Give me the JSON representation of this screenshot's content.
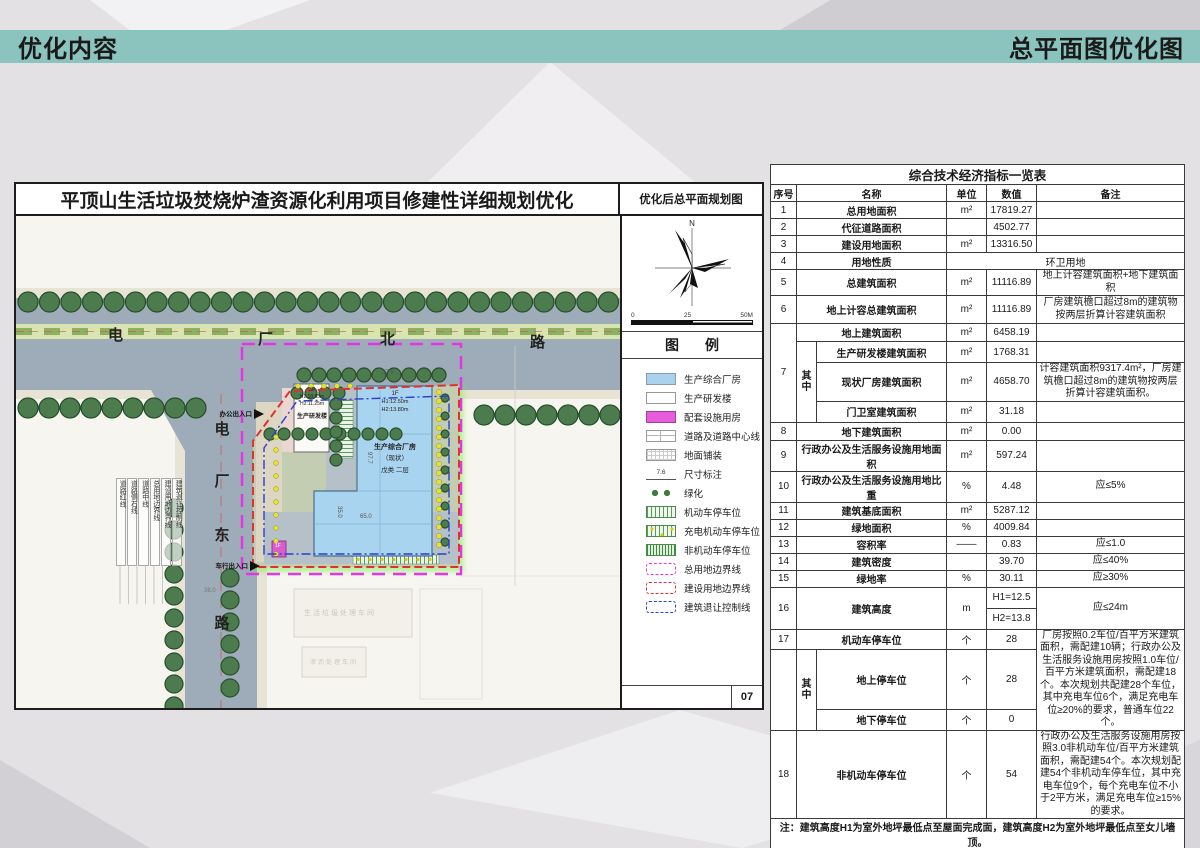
{
  "header": {
    "left_title": "优化内容",
    "right_title": "总平面图优化图"
  },
  "colors": {
    "accent_teal": "#8bc3bf",
    "boundary_magenta": "#e336e3",
    "boundary_red": "#e03030",
    "setback_blue": "#2b3fd0",
    "building_blue": "#a9d4f0",
    "road_gray": "#9dacb8"
  },
  "plan": {
    "title": "平顶山生活垃圾焚烧炉渣资源化利用项目修建性详细规划优化",
    "subtitle": "优化后总平面规划图",
    "page_number": "07",
    "compass_north": "N",
    "scale": {
      "start": "0",
      "mid": "25",
      "end": "50M"
    },
    "legend_title": "图例",
    "legend_items": [
      {
        "label": "生产综合厂房",
        "type": "fill-blue"
      },
      {
        "label": "生产研发楼",
        "type": "fill-white"
      },
      {
        "label": "配套设施用房",
        "type": "fill-magenta"
      },
      {
        "label": "道路及道路中心线",
        "type": "road"
      },
      {
        "label": "地面铺装",
        "type": "paving"
      },
      {
        "label": "尺寸标注",
        "type": "dimension",
        "sample": "7.6"
      },
      {
        "label": "绿化",
        "type": "trees"
      },
      {
        "label": "机动车停车位",
        "type": "parking"
      },
      {
        "label": "充电机动车停车位",
        "type": "parking-ev"
      },
      {
        "label": "非机动车停车位",
        "type": "parking-bike"
      },
      {
        "label": "总用地边界线",
        "type": "dash-magenta"
      },
      {
        "label": "建设用地边界线",
        "type": "dash-red"
      },
      {
        "label": "建筑退让控制线",
        "type": "dash-blue"
      }
    ],
    "map": {
      "road_h_name": [
        "电",
        "厂",
        "北",
        "路"
      ],
      "road_v_name": [
        "电",
        "厂",
        "东",
        "路"
      ],
      "buildings": {
        "rnd": {
          "floors": "3F",
          "h1": "H1:10.65m",
          "h2": "H2:11.25m",
          "name": "生产研发楼"
        },
        "factory": {
          "floors": "1F",
          "h1": "H1:12.50m",
          "h2": "H2:13.80m",
          "name": "生产综合厂房",
          "name2": "（现状）",
          "name3": "戊类 二层"
        },
        "gatehouse": {
          "floors": "1F"
        }
      },
      "labels": {
        "office_entrance": "办公出入口",
        "vehicle_entrance": "车行出入口",
        "adjacent1": "生活垃圾处理车间",
        "adjacent2": "渗沥处理车间"
      },
      "dims": {
        "top": "37.6",
        "side": "97.7",
        "inner": "65.0",
        "inner2": "35.0",
        "road": "38.0"
      },
      "line_labels": [
        "道路红线",
        "道路侧石线",
        "道路中线",
        "总用地边界线",
        "建设用地边界线",
        "建筑退让控制线"
      ]
    }
  },
  "table": {
    "rows": [
      {
        "cls": "h20 title-row",
        "cells": [
          {
            "t": "综合技术经济指标一览表",
            "c": 6,
            "cls": "tt"
          }
        ]
      },
      {
        "cls": "h17 head-row",
        "cells": [
          {
            "t": "序号"
          },
          {
            "t": "名称",
            "c": 2
          },
          {
            "t": "单位"
          },
          {
            "t": "数值"
          },
          {
            "t": "备注"
          }
        ]
      },
      {
        "cls": "h17",
        "cells": [
          {
            "t": "1"
          },
          {
            "t": "总用地面积",
            "c": 2,
            "cls": "name"
          },
          {
            "t": "m²"
          },
          {
            "t": "17819.27"
          },
          {
            "t": ""
          }
        ]
      },
      {
        "cls": "h17",
        "cells": [
          {
            "t": "2"
          },
          {
            "t": "代征道路面积",
            "c": 2,
            "cls": "name"
          },
          {
            "t": ""
          },
          {
            "t": "4502.77"
          },
          {
            "t": ""
          }
        ]
      },
      {
        "cls": "h17",
        "cells": [
          {
            "t": "3"
          },
          {
            "t": "建设用地面积",
            "c": 2,
            "cls": "name"
          },
          {
            "t": "m²"
          },
          {
            "t": "13316.50"
          },
          {
            "t": ""
          }
        ]
      },
      {
        "cls": "h17",
        "cells": [
          {
            "t": "4"
          },
          {
            "t": "用地性质",
            "c": 2,
            "cls": "name"
          },
          {
            "t": "环卫用地",
            "c": 3
          }
        ]
      },
      {
        "cls": "h21",
        "cells": [
          {
            "t": "5"
          },
          {
            "t": "总建筑面积",
            "c": 2,
            "cls": "name"
          },
          {
            "t": "m²"
          },
          {
            "t": "11116.89"
          },
          {
            "t": "地上计容建筑面积+地下建筑面积",
            "cls": "remark"
          }
        ]
      },
      {
        "cls": "h28",
        "cells": [
          {
            "t": "6"
          },
          {
            "t": "地上计容总建筑面积",
            "c": 2,
            "cls": "name"
          },
          {
            "t": "m²"
          },
          {
            "t": "11116.89"
          },
          {
            "t": "厂房建筑檐口超过8m的建筑物按两层折算计容建筑面积",
            "cls": "remark"
          }
        ]
      },
      {
        "cls": "h18",
        "cells": [
          {
            "t": "7",
            "r": 4
          },
          {
            "t": "地上建筑面积",
            "c": 2,
            "cls": "name"
          },
          {
            "t": "m²"
          },
          {
            "t": "6458.19"
          },
          {
            "t": ""
          }
        ]
      },
      {
        "cls": "h21",
        "cells": [
          {
            "t": "其中",
            "r": 3,
            "cls": "qz"
          },
          {
            "t": "生产研发楼建筑面积",
            "cls": "name"
          },
          {
            "t": "m²"
          },
          {
            "t": "1768.31"
          },
          {
            "t": ""
          }
        ]
      },
      {
        "cls": "h30",
        "cells": [
          {
            "t": "现状厂房建筑面积",
            "cls": "name"
          },
          {
            "t": "m²"
          },
          {
            "t": "4658.70"
          },
          {
            "t": "计容建筑面积9317.4m²，厂房建筑檐口超过8m的建筑物按两层折算计容建筑面积。",
            "cls": "remark"
          }
        ]
      },
      {
        "cls": "h21",
        "cells": [
          {
            "t": "门卫室建筑面积",
            "cls": "name"
          },
          {
            "t": "m²"
          },
          {
            "t": "31.18"
          },
          {
            "t": ""
          }
        ]
      },
      {
        "cls": "h18",
        "cells": [
          {
            "t": "8"
          },
          {
            "t": "地下建筑面积",
            "c": 2,
            "cls": "name"
          },
          {
            "t": "m²"
          },
          {
            "t": "0.00"
          },
          {
            "t": ""
          }
        ]
      },
      {
        "cls": "h24",
        "cells": [
          {
            "t": "9"
          },
          {
            "t": "行政办公及生活服务设施用地面积",
            "c": 2,
            "cls": "name"
          },
          {
            "t": "m²"
          },
          {
            "t": "597.24"
          },
          {
            "t": ""
          }
        ]
      },
      {
        "cls": "h24",
        "cells": [
          {
            "t": "10"
          },
          {
            "t": "行政办公及生活服务设施用地比重",
            "c": 2,
            "cls": "name"
          },
          {
            "t": "%"
          },
          {
            "t": "4.48"
          },
          {
            "t": "应≤5%",
            "cls": "remark ctr"
          }
        ]
      },
      {
        "cls": "h17",
        "cells": [
          {
            "t": "11"
          },
          {
            "t": "建筑基底面积",
            "c": 2,
            "cls": "name"
          },
          {
            "t": "m²"
          },
          {
            "t": "5287.12"
          },
          {
            "t": ""
          }
        ]
      },
      {
        "cls": "h17",
        "cells": [
          {
            "t": "12"
          },
          {
            "t": "绿地面积",
            "c": 2,
            "cls": "name"
          },
          {
            "t": "%"
          },
          {
            "t": "4009.84"
          },
          {
            "t": ""
          }
        ]
      },
      {
        "cls": "h17",
        "cells": [
          {
            "t": "13"
          },
          {
            "t": "容积率",
            "c": 2,
            "cls": "name"
          },
          {
            "t": "——"
          },
          {
            "t": "0.83"
          },
          {
            "t": "应≤1.0",
            "cls": "remark ctr"
          }
        ]
      },
      {
        "cls": "h17",
        "cells": [
          {
            "t": "14"
          },
          {
            "t": "建筑密度",
            "c": 2,
            "cls": "name"
          },
          {
            "t": ""
          },
          {
            "t": "39.70"
          },
          {
            "t": "应≤40%",
            "cls": "remark ctr"
          }
        ]
      },
      {
        "cls": "h17",
        "cells": [
          {
            "t": "15"
          },
          {
            "t": "绿地率",
            "c": 2,
            "cls": "name"
          },
          {
            "t": "%"
          },
          {
            "t": "30.11"
          },
          {
            "t": "应≥30%",
            "cls": "remark ctr"
          }
        ]
      },
      {
        "cls": "h21",
        "cells": [
          {
            "t": "16",
            "r": 2
          },
          {
            "t": "建筑高度",
            "c": 2,
            "r": 2,
            "cls": "name"
          },
          {
            "t": "m",
            "r": 2
          },
          {
            "t": "H1=12.5"
          },
          {
            "t": "应≤24m",
            "r": 2,
            "cls": "remark ctr"
          }
        ]
      },
      {
        "cls": "h21",
        "cells": [
          {
            "t": "H2=13.8"
          }
        ]
      },
      {
        "cls": "h20",
        "cells": [
          {
            "t": "17"
          },
          {
            "t": "机动车停车位",
            "c": 2,
            "cls": "name"
          },
          {
            "t": "个"
          },
          {
            "t": "28"
          },
          {
            "t": "厂房按照0.2车位/百平方米建筑面积，需配建10辆；行政办公及生活服务设施用房按照1.0车位/百平方米建筑面积，需配建18个。本次规划共配建28个车位，其中充电车位6个，满足充电车位≥20%的要求，普通车位22个。",
            "r": 3,
            "cls": "remark"
          }
        ]
      },
      {
        "cls": "h21",
        "cells": [
          {
            "t": "",
            "r": 2
          },
          {
            "t": "其中",
            "r": 2,
            "cls": "qz"
          },
          {
            "t": "地上停车位",
            "cls": "name"
          },
          {
            "t": "个"
          },
          {
            "t": "28"
          }
        ]
      },
      {
        "cls": "h21",
        "cells": [
          {
            "t": "地下停车位",
            "cls": "name"
          },
          {
            "t": "个"
          },
          {
            "t": "0"
          }
        ]
      },
      {
        "cls": "h78",
        "cells": [
          {
            "t": "18"
          },
          {
            "t": "非机动车停车位",
            "c": 2,
            "cls": "name"
          },
          {
            "t": "个"
          },
          {
            "t": "54"
          },
          {
            "t": "行政办公及生活服务设施用房按照3.0非机动车位/百平方米建筑面积，需配建54个。本次规划配建54个非机动车停车位，其中充电车位9个，每个充电车位不小于2平方米，满足充电车位≥15%的要求。",
            "cls": "remark"
          }
        ]
      },
      {
        "cls": "h24",
        "cells": [
          {
            "t": "注：建筑高度H1为室外地坪最低点至屋面完成面，建筑高度H2为室外地坪最低点至女儿墙顶。",
            "c": 6,
            "cls": "notecell"
          }
        ]
      }
    ]
  }
}
